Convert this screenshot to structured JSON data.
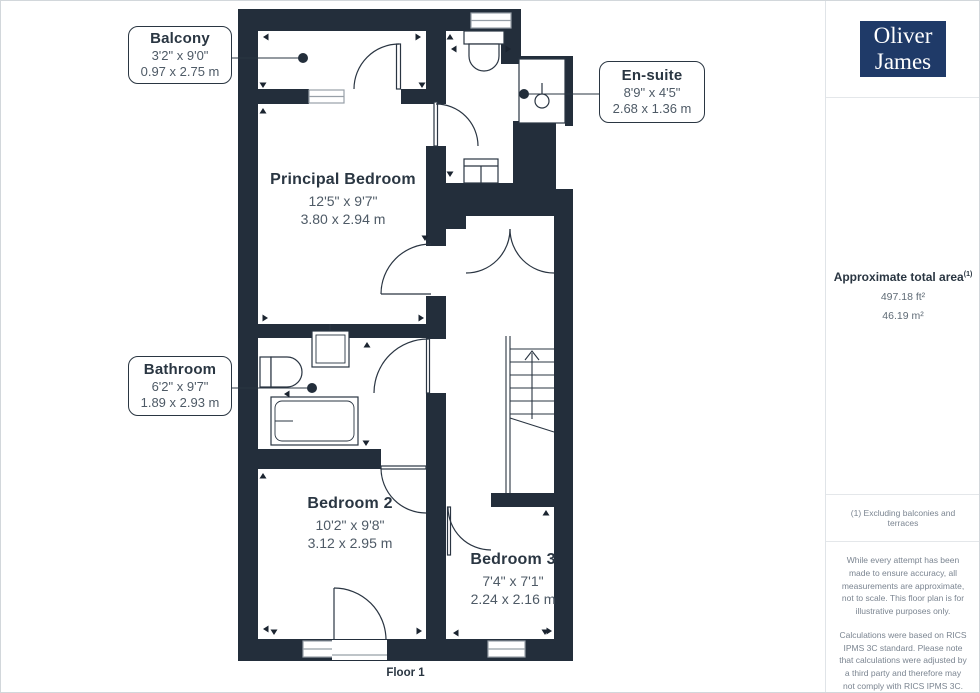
{
  "page": {
    "floor_label": "Floor 1"
  },
  "branding": {
    "logo_line1": "Oliver",
    "logo_line2": "James"
  },
  "rooms": [
    {
      "name": "Balcony",
      "imperial": "3'2\" x 9'0\"",
      "metric": "0.97 x 2.75 m"
    },
    {
      "name": "En-suite",
      "imperial": "8'9\" x 4'5\"",
      "metric": "2.68 x 1.36 m"
    },
    {
      "name": "Principal Bedroom",
      "imperial": "12'5\" x 9'7\"",
      "metric": "3.80 x 2.94 m"
    },
    {
      "name": "Bathroom",
      "imperial": "6'2\" x 9'7\"",
      "metric": "1.89 x 2.93 m"
    },
    {
      "name": "Bedroom 2",
      "imperial": "10'2\" x 9'8\"",
      "metric": "3.12 x 2.95 m"
    },
    {
      "name": "Bedroom 3",
      "imperial": "7'4\" x 7'1\"",
      "metric": "2.24 x 2.16 m"
    }
  ],
  "sidebar": {
    "area_title": "Approximate total area",
    "area_footnote_ref": "(1)",
    "area_imperial": "497.18 ft²",
    "area_metric": "46.19 m²",
    "footnote": "(1) Excluding balconies and terraces",
    "disclaimer_1": "While every attempt has been made to ensure accuracy, all measurements are approximate, not to scale. This floor plan is for illustrative purposes only.",
    "disclaimer_2": "Calculations were based on RICS IPMS 3C standard. Please note that calculations were adjusted by a third party and therefore may not comply with RICS IPMS 3C.",
    "provider_name": "GIRAFFE",
    "provider_number": "360"
  },
  "colors": {
    "wall": "#232e3b",
    "logo_bg": "#1f3a68",
    "accent_text": "#2a3642",
    "dim_text": "#4e5a66"
  }
}
